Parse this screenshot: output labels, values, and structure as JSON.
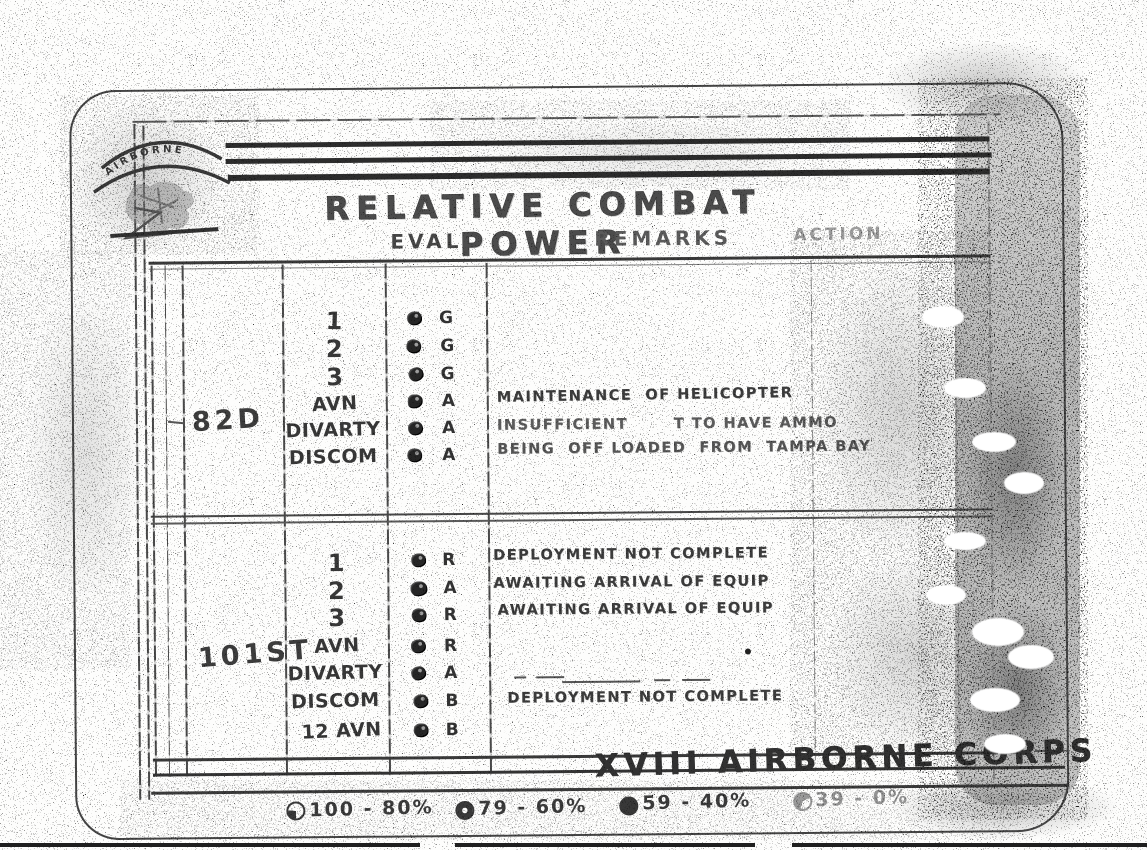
{
  "page": {
    "title": "RELATIVE COMBAT POWER",
    "footer_org": "XVIII AIRBORNE CORPS"
  },
  "logo": {
    "arc_text": "AIRBORNE"
  },
  "headers": {
    "eval": "EVAL",
    "remarks": "REMARKS",
    "action": "ACTION"
  },
  "sections": [
    {
      "division": "82D",
      "rows": [
        {
          "unit": "1",
          "eval": "G",
          "remark": ""
        },
        {
          "unit": "2",
          "eval": "G",
          "remark": ""
        },
        {
          "unit": "3",
          "eval": "G",
          "remark": ""
        },
        {
          "unit": "AVN",
          "eval": "A",
          "remark": "MAINTENANCE  OF HELICOPTER"
        },
        {
          "unit": "DIVARTY",
          "eval": "A",
          "remark": "INSUFFICIENT       T TO HAVE AMMO"
        },
        {
          "unit": "DISCOM",
          "eval": "A",
          "remark": "BEING  OFF LOADED  FROM  TAMPA BAY"
        }
      ]
    },
    {
      "division": "101ST",
      "rows": [
        {
          "unit": "1",
          "eval": "R",
          "remark": "DEPLOYMENT NOT COMPLETE"
        },
        {
          "unit": "2",
          "eval": "A",
          "remark": "AWAITING ARRIVAL OF EQUIP"
        },
        {
          "unit": "3",
          "eval": "R",
          "remark": "AWAITING ARRIVAL OF EQUIP"
        },
        {
          "unit": "AVN",
          "eval": "R",
          "remark": ""
        },
        {
          "unit": "DIVARTY",
          "eval": "A",
          "remark": ""
        },
        {
          "unit": "DISCOM",
          "eval": "B",
          "remark": "DEPLOYMENT NOT COMPLETE"
        },
        {
          "unit": "12 AVN",
          "eval": "B",
          "remark": ""
        }
      ]
    }
  ],
  "legend": [
    {
      "range": "100 - 80%"
    },
    {
      "range": "79 - 60%"
    },
    {
      "range": "59 - 40%"
    },
    {
      "range": "39 - 0%"
    }
  ],
  "colors": {
    "ink": "#333333",
    "faded": "#999999"
  }
}
